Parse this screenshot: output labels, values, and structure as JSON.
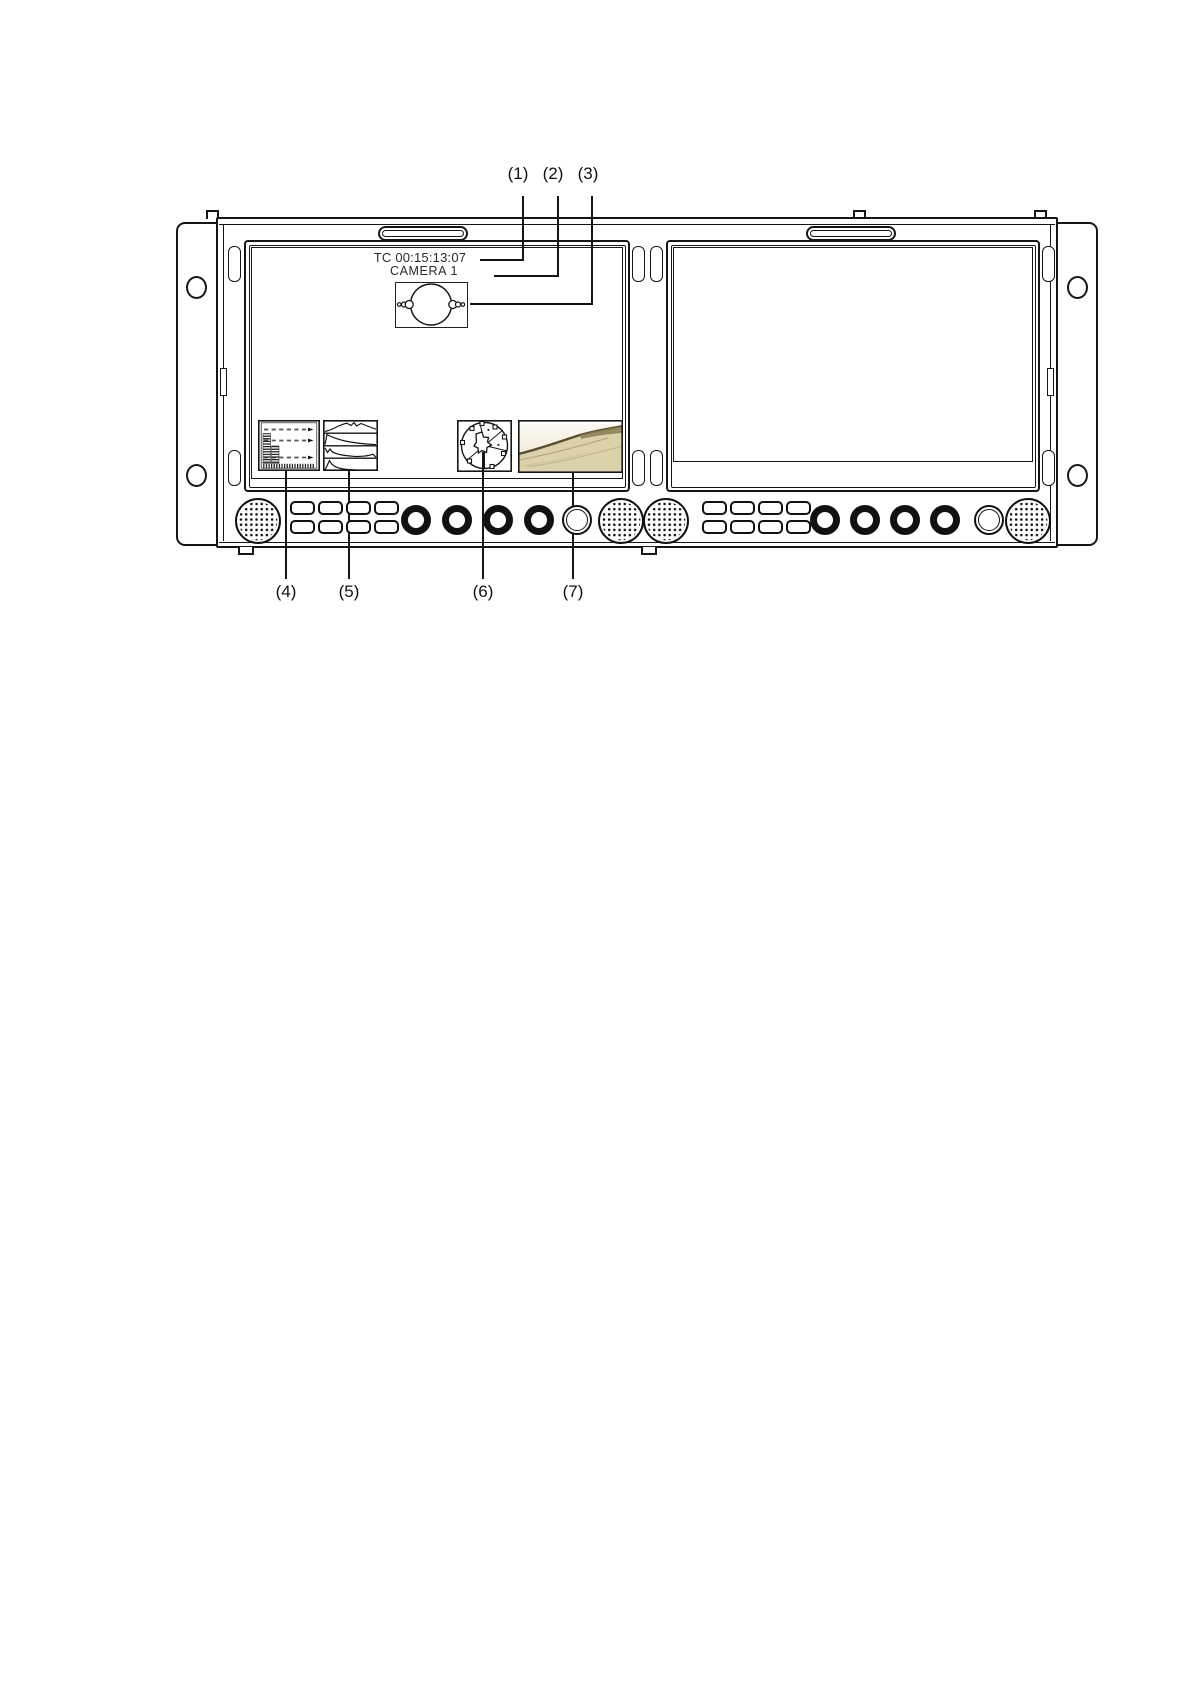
{
  "callouts": {
    "top": [
      {
        "label": "(1)"
      },
      {
        "label": "(2)"
      },
      {
        "label": "(3)"
      }
    ],
    "bottom": [
      {
        "label": "(4)"
      },
      {
        "label": "(5)"
      },
      {
        "label": "(6)"
      },
      {
        "label": "(7)"
      }
    ]
  },
  "osd": {
    "timecode": "TC 00:15:13:07",
    "camera_id": "CAMERA 1"
  },
  "icons": [
    "reel-graphic-icon",
    "audio-level-meter-overlay",
    "waveform-monitor-overlay",
    "vectorscope-overlay",
    "picture-thumbnail-overlay",
    "speaker-grille-icon",
    "rack-mounting-hole"
  ],
  "colors": {
    "line": "#161616",
    "osd_text": "#2a2a2a",
    "photo_sand": "#dbd2ab",
    "photo_ridge": "#5a4e31",
    "photo_sky": "#f7f4e8"
  }
}
